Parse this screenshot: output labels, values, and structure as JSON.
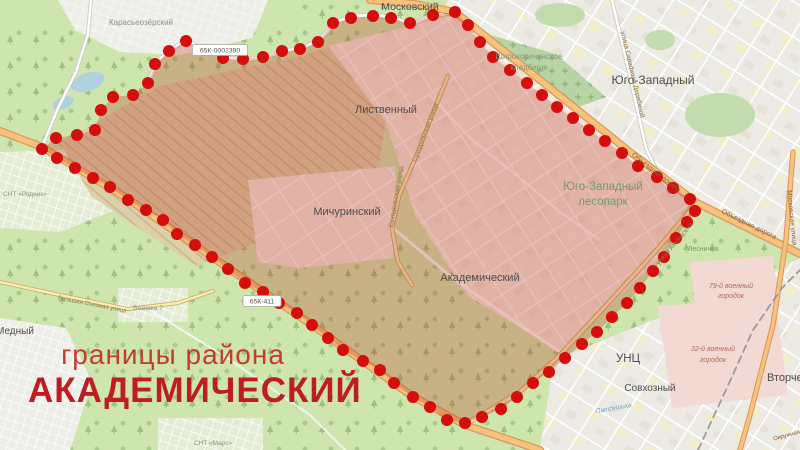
{
  "title": {
    "subtitle": "границы района",
    "district": "АКАДЕМИЧЕСКИЙ",
    "subtitle_color": "#c43b30",
    "district_color": "#bd1d23"
  },
  "map": {
    "background_color": "#cfe5ae",
    "overlay_color": "rgba(185,55,35,0.30)",
    "dot_color": "#d40d0d",
    "dot_radius": 6,
    "boundary": [
      [
        455,
        12
      ],
      [
        468,
        25
      ],
      [
        480,
        42
      ],
      [
        493,
        57
      ],
      [
        510,
        70
      ],
      [
        527,
        83
      ],
      [
        542,
        95
      ],
      [
        557,
        107
      ],
      [
        573,
        118
      ],
      [
        589,
        130
      ],
      [
        605,
        141
      ],
      [
        622,
        153
      ],
      [
        638,
        166
      ],
      [
        657,
        177
      ],
      [
        673,
        188
      ],
      [
        690,
        199
      ],
      [
        695,
        211
      ],
      [
        687,
        222
      ],
      [
        676,
        238
      ],
      [
        664,
        257
      ],
      [
        653,
        271
      ],
      [
        640,
        288
      ],
      [
        627,
        303
      ],
      [
        612,
        317
      ],
      [
        597,
        332
      ],
      [
        582,
        344
      ],
      [
        565,
        358
      ],
      [
        549,
        372
      ],
      [
        533,
        383
      ],
      [
        517,
        397
      ],
      [
        501,
        409
      ],
      [
        482,
        417
      ],
      [
        465,
        423
      ],
      [
        447,
        420
      ],
      [
        430,
        407
      ],
      [
        413,
        397
      ],
      [
        394,
        383
      ],
      [
        380,
        370
      ],
      [
        363,
        361
      ],
      [
        343,
        350
      ],
      [
        328,
        338
      ],
      [
        312,
        325
      ],
      [
        297,
        313
      ],
      [
        279,
        303
      ],
      [
        263,
        292
      ],
      [
        245,
        283
      ],
      [
        228,
        269
      ],
      [
        212,
        257
      ],
      [
        195,
        245
      ],
      [
        177,
        234
      ],
      [
        163,
        220
      ],
      [
        146,
        210
      ],
      [
        128,
        200
      ],
      [
        110,
        187
      ],
      [
        93,
        178
      ],
      [
        75,
        168
      ],
      [
        57,
        158
      ],
      [
        42,
        149
      ],
      [
        56,
        138
      ],
      [
        77,
        135
      ],
      [
        95,
        130
      ],
      [
        101,
        110
      ],
      [
        113,
        97
      ],
      [
        133,
        95
      ],
      [
        148,
        83
      ],
      [
        155,
        64
      ],
      [
        169,
        51
      ],
      [
        186,
        41
      ],
      [
        203,
        50
      ],
      [
        223,
        58
      ],
      [
        243,
        59
      ],
      [
        263,
        57
      ],
      [
        282,
        51
      ],
      [
        300,
        49
      ],
      [
        318,
        42
      ],
      [
        333,
        23
      ],
      [
        351,
        18
      ],
      [
        373,
        16
      ],
      [
        391,
        18
      ],
      [
        410,
        23
      ],
      [
        433,
        15
      ]
    ],
    "labels": [
      {
        "t": "Московский",
        "x": 410,
        "y": 10,
        "s": 10.5,
        "c": "#4e4e4e"
      },
      {
        "t": "Карасьеозёрский",
        "x": 141,
        "y": 25,
        "s": 8,
        "c": "#8d8d8d"
      },
      {
        "t": "Широкореченское",
        "x": 529,
        "y": 59,
        "s": 8,
        "c": "#7c9a78"
      },
      {
        "t": "кладбище",
        "x": 529,
        "y": 70,
        "s": 8,
        "c": "#7c9a78"
      },
      {
        "t": "Юго-Западный",
        "x": 653,
        "y": 84,
        "s": 12,
        "c": "#4e4e4e"
      },
      {
        "t": "Лиственный",
        "x": 386,
        "y": 113,
        "s": 11,
        "c": "#4e4e4e"
      },
      {
        "t": "Мичуринский",
        "x": 347,
        "y": 215,
        "s": 11,
        "c": "#4e4e4e"
      },
      {
        "t": "Академический",
        "x": 480,
        "y": 281,
        "s": 11,
        "c": "#4e4e4e"
      },
      {
        "t": "Юго-Западный",
        "x": 603,
        "y": 190,
        "s": 11.5,
        "c": "#78996f"
      },
      {
        "t": "лесопарк",
        "x": 603,
        "y": 205,
        "s": 11.5,
        "c": "#78996f"
      },
      {
        "t": "Объездная дорога",
        "x": 655,
        "y": 174,
        "s": 7,
        "c": "#8a5f35",
        "r": 38
      },
      {
        "t": "Объездная дорога",
        "x": 748,
        "y": 226,
        "s": 7,
        "c": "#8a5f35",
        "r": 26
      },
      {
        "t": "улица Амундсена",
        "x": 676,
        "y": 245,
        "s": 6.5,
        "c": "#8a7747",
        "r": -50
      },
      {
        "t": "Суходольская улица",
        "x": 427,
        "y": 133,
        "s": 6.5,
        "c": "#8a7747",
        "r": -70
      },
      {
        "t": "Суходольская улица",
        "x": 398,
        "y": 197,
        "s": 6.5,
        "c": "#8a7747",
        "r": -80
      },
      {
        "t": "улица Серафимы Дерябиной",
        "x": 631,
        "y": 75,
        "s": 6.5,
        "c": "#8a7747",
        "r": 77
      },
      {
        "t": "Московская улица",
        "x": 790,
        "y": 218,
        "s": 6.5,
        "c": "#8a5f35",
        "r": 84
      },
      {
        "t": "Лесничка",
        "x": 703,
        "y": 251,
        "s": 7,
        "c": "#78996f"
      },
      {
        "t": "79-й военный",
        "x": 731,
        "y": 288,
        "s": 7,
        "c": "#b5645f",
        "i": 1
      },
      {
        "t": "городок",
        "x": 731,
        "y": 298,
        "s": 7,
        "c": "#b5645f",
        "i": 1
      },
      {
        "t": "32-й военный",
        "x": 713,
        "y": 351,
        "s": 7,
        "c": "#b5645f",
        "i": 1
      },
      {
        "t": "городок",
        "x": 713,
        "y": 362,
        "s": 7,
        "c": "#b5645f",
        "i": 1
      },
      {
        "t": "УНЦ",
        "x": 628,
        "y": 362,
        "s": 11.5,
        "c": "#4e4e4e"
      },
      {
        "t": "Совхозный",
        "x": 650,
        "y": 391,
        "s": 10,
        "c": "#4e4e4e"
      },
      {
        "t": "Вторчермет",
        "x": 767,
        "y": 381,
        "s": 11,
        "c": "#4e4e4e",
        "a": "start"
      },
      {
        "t": "Медный",
        "x": -4,
        "y": 334,
        "s": 10,
        "c": "#4e4e4e",
        "a": "start"
      },
      {
        "t": "СНТ «Родник»",
        "x": 3,
        "y": 196,
        "s": 6.5,
        "c": "#8d8d8d",
        "a": "start"
      },
      {
        "t": "Вязовка 7",
        "x": 148,
        "y": 310,
        "s": 6.5,
        "c": "#8d8d8d"
      },
      {
        "t": "СНТ «Марс»",
        "x": 213,
        "y": 445,
        "s": 6.5,
        "c": "#8d8d8d"
      },
      {
        "t": "Большая Съезжая улица",
        "x": 92,
        "y": 306,
        "s": 6,
        "c": "#8a7747",
        "r": 11
      },
      {
        "t": "Патрушиха",
        "x": 614,
        "y": 410,
        "s": 6.5,
        "c": "#6fa7c2",
        "i": 1,
        "r": -10
      },
      {
        "t": "Окружная",
        "x": 787,
        "y": 437,
        "s": 6,
        "c": "#8a5f35",
        "r": -15
      }
    ],
    "road_refs": [
      {
        "t": "65К-0002390",
        "x": 220,
        "y": 50
      },
      {
        "t": "65К-411",
        "x": 262,
        "y": 301
      }
    ]
  }
}
